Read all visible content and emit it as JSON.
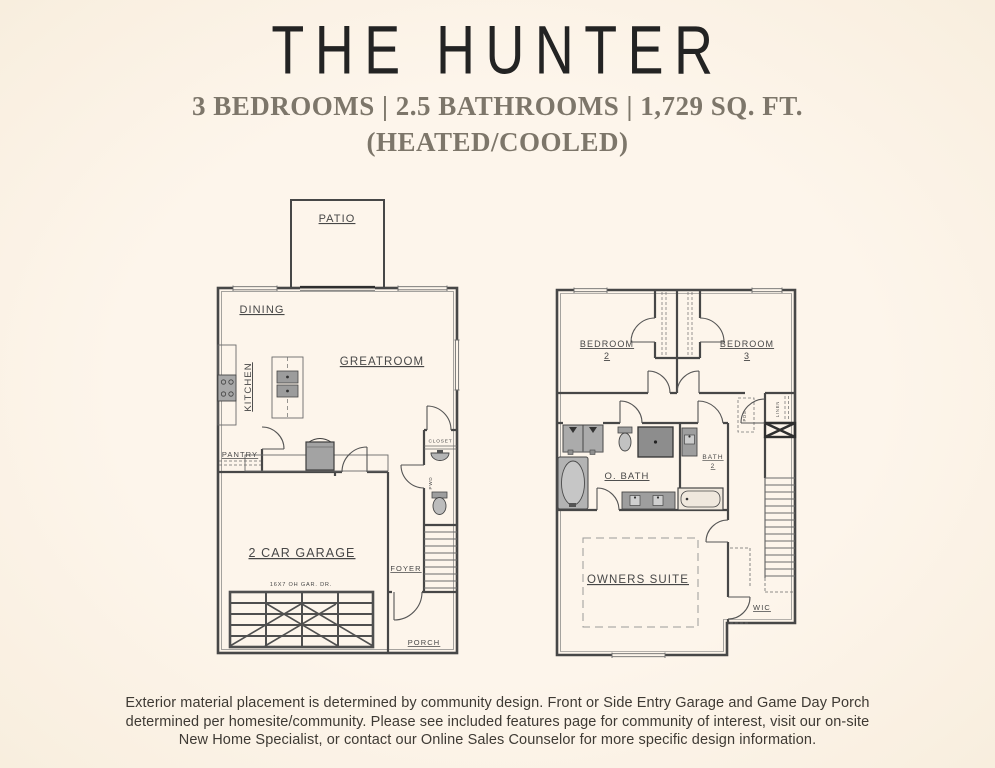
{
  "colors": {
    "background": "#fdf5eb",
    "title_text": "#232323",
    "subtitle_text": "#7d766a",
    "plan_lines": "#474747",
    "fixture_gray": "#a8a8a8",
    "footer_text": "#3e3a34"
  },
  "header": {
    "title": "THE HUNTER",
    "subtitle": "3 BEDROOMS | 2.5 BATHROOMS | 1,729 SQ. FT.",
    "subtitle2": "(HEATED/COOLED)"
  },
  "first_floor": {
    "patio": "PATIO",
    "dining": "DINING",
    "kitchen": "KITCHEN",
    "greatroom": "GREATROOM",
    "pantry": "PANTRY",
    "closet": "CLOSET",
    "powder": "PWD",
    "foyer": "FOYER",
    "garage": "2 CAR GARAGE",
    "garage_door_label": "16X7 OH GAR. DR.",
    "porch": "PORCH"
  },
  "second_floor": {
    "bedroom2": "BEDROOM",
    "bedroom2_num": "2",
    "bedroom3": "BEDROOM",
    "bedroom3_num": "3",
    "owners_bath": "O. BATH",
    "bath2": "BATH",
    "bath2_num": "2",
    "owners_suite": "OWNERS SUITE",
    "wic": "WIC",
    "linen": "LINEN",
    "pds": "PDS"
  },
  "footer": {
    "line1": "Exterior material placement is determined by community design. Front or Side Entry Garage and Game Day Porch",
    "line2": "determined per homesite/community. Please see included features page for community of interest, visit our on-site",
    "line3": "New Home Specialist, or contact our Online Sales Counselor for more specific design information."
  }
}
